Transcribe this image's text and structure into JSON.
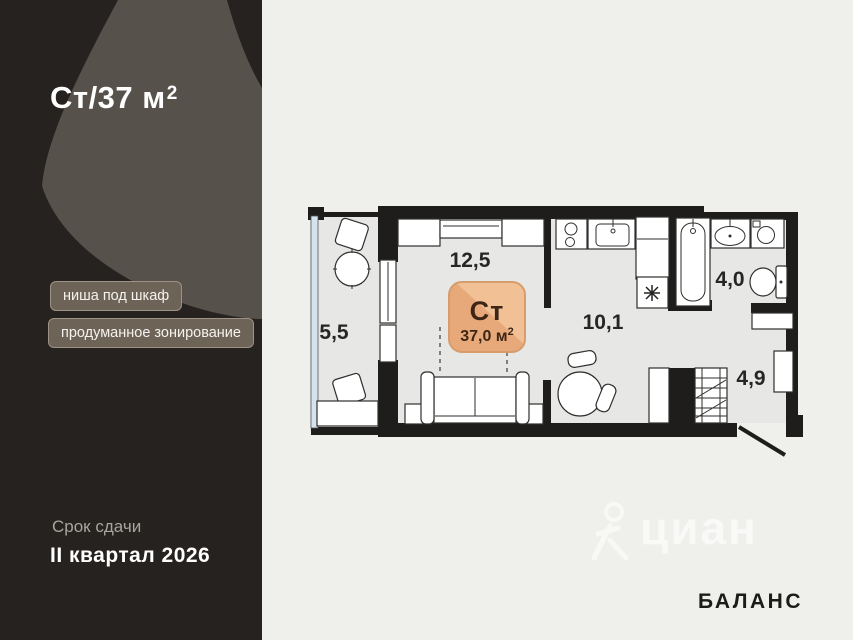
{
  "panel": {
    "title_main": "Ст/37 м",
    "title_sup": "2",
    "tags": [
      {
        "label": "ниша под шкаф"
      },
      {
        "label": "продуманное зонирование"
      }
    ],
    "deadline_label": "Срок сдачи",
    "deadline_value": "II квартал 2026"
  },
  "plan": {
    "badge": {
      "type": "Ст",
      "area_main": "37,0 м",
      "area_sup": "2"
    },
    "rooms": {
      "living": "12,5",
      "balcony": "5,5",
      "kitchen": "10,1",
      "bathroom": "4,0",
      "hallway": "4,9"
    }
  },
  "branding": {
    "developer": "БАЛАНС",
    "watermark": "циан"
  },
  "colors": {
    "panel_dark": "#26221f",
    "panel_swoosh": "#57514b",
    "badge_fill": "#e9ad7e",
    "badge_border": "#d79c6c",
    "wall": "#1e1d1b",
    "floor": "#e7e8e5",
    "glazing": "#d6e2ee"
  }
}
